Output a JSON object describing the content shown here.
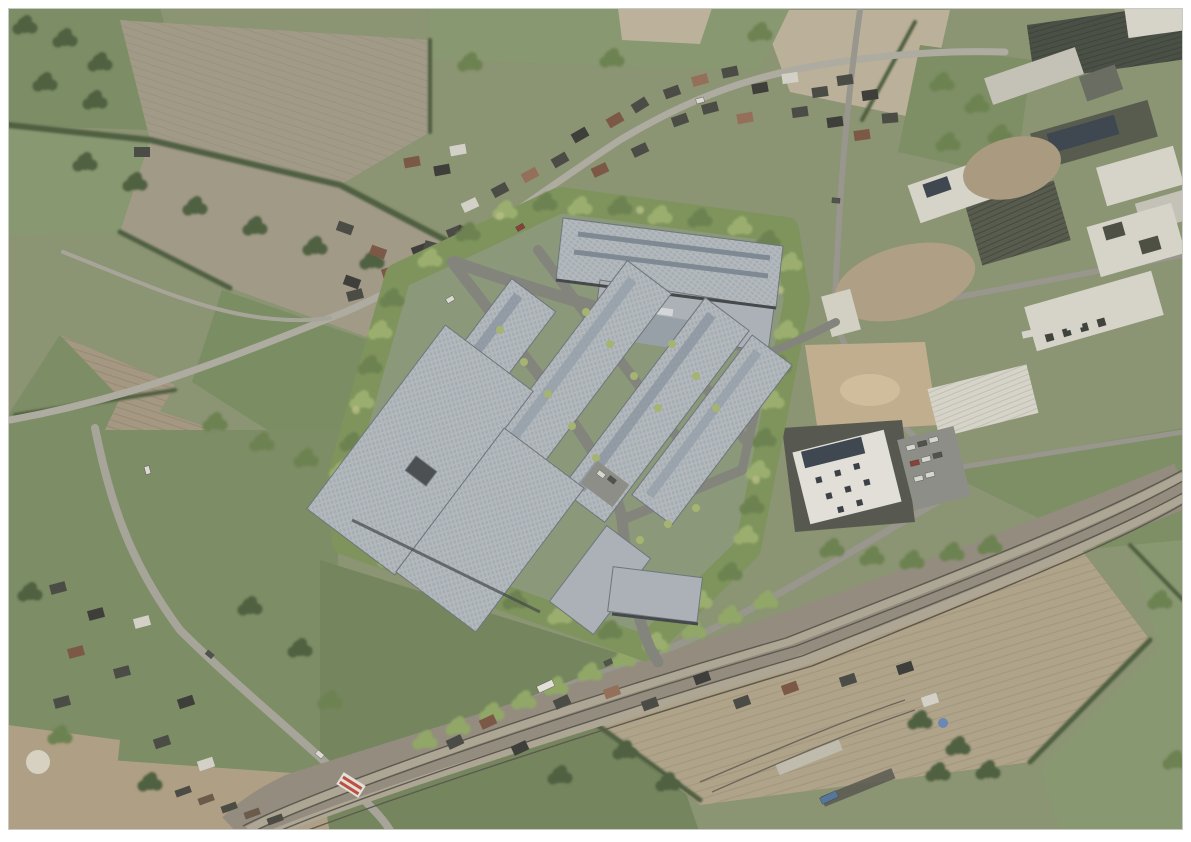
{
  "meta": {
    "content_type": "aerial-render-visualization",
    "description": "Oblique aerial photograph with a photomontage render of a proposed business park: rows of grey warehouse units with rooftop solar panels surrounded by a new tree belt, set between a village, farmland, a railway line and an existing industrial estate.",
    "image_width_px": 1191,
    "image_height_px": 842,
    "visible_text": []
  },
  "palette": {
    "page_background": "#ffffff",
    "base_ground": "#8d9674",
    "field_green": "#7e8f66",
    "field_green_light": "#8a9a72",
    "field_green_dark": "#75875f",
    "pasture": "#7c8f64",
    "plowed_gray_brown": "#a49c8a",
    "plowed_brown": "#a89a84",
    "plowed_pale": "#b3a68d",
    "pale_field": "#bfb49c",
    "dirt": "#b3a286",
    "sand": "#c6b292",
    "road_light": "#b2afa4",
    "road_main": "#aaa89d",
    "road_dark_asphalt": "#84867e",
    "railway_corridor": "#968f81",
    "rail_line": "#5c584f",
    "tree_dark": "#4e6040",
    "tree_mid": "#6d8351",
    "tree_light": "#93aa68",
    "tree_belt": "#9db26f",
    "warehouse_roof": "#b7bdc2",
    "warehouse_roof_mid": "#aeb5bb",
    "warehouse_wall": "#45494d",
    "solar_panel": "#3d4650",
    "industrial_white_roof": "#dcd9ce",
    "industrial_dark_roof": "#575b4e",
    "house_roof_dark": "#4a4a45",
    "house_roof_red": "#7d5846",
    "house_roof_white": "#d9d6cd",
    "pool_blue": "#6fa8cc",
    "crossing_red": "#c05040",
    "office_plot": "#565850"
  },
  "scene": {
    "regions": [
      "new-business-park-render",
      "perimeter-tree-belt",
      "warehouse-rows",
      "north-warehouse-complex",
      "southwest-warehouse-complex",
      "village-main-street",
      "west-residential-cluster",
      "south-residential-strip",
      "plowed-fields",
      "pastures",
      "railway-line",
      "level-crossing",
      "existing-industrial-estate",
      "office-building-with-solar-roof",
      "sand-yard",
      "parking-lots",
      "hedgerows",
      "tree-clusters"
    ]
  }
}
